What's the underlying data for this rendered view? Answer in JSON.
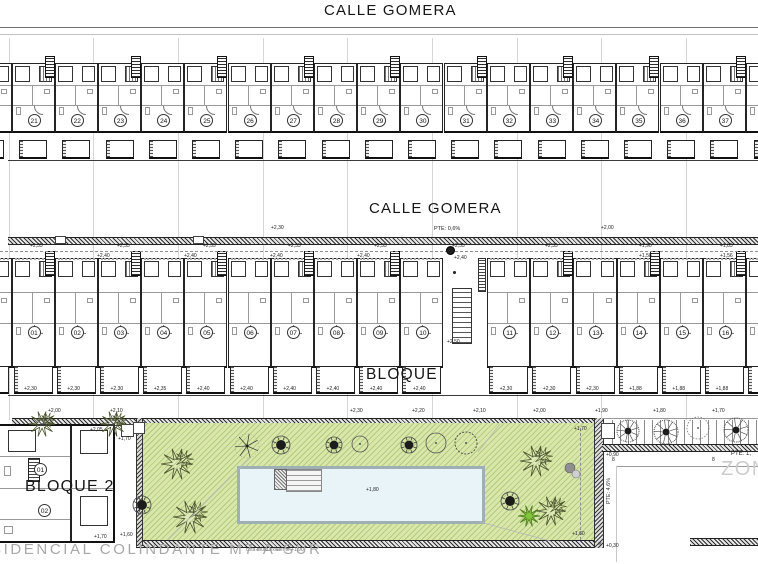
{
  "drawing": {
    "street_top": "CALLE GOMERA",
    "street_mid": "CALLE GOMERA",
    "street_slope": "PTE: 0,6%",
    "bloque1_label": "BLOQUE 1",
    "bloque2_label": "BLOQUE 2",
    "adjacent_text": "SIDENCIAL COLINDANTE M7-A-SUR",
    "wall_note": "cota muro existente +1,90",
    "zona_label": "ZONA",
    "pte_right": "PTE: 1,",
    "ramp_slope": "PTE: 4,6%",
    "ramp_level_top": "+0,90",
    "ramp_level_bottom": "+0,30",
    "cross_mark": "×"
  },
  "row1": {
    "units": [
      "21",
      "22",
      "23",
      "24",
      "25",
      "26",
      "27",
      "28",
      "29",
      "30",
      "31",
      "32",
      "33",
      "34",
      "35",
      "36",
      "37"
    ]
  },
  "row2": {
    "left_units": [
      {
        "num": "01",
        "patio_level": "+2,30"
      },
      {
        "num": "02",
        "patio_level": "+2,30"
      },
      {
        "num": "03",
        "patio_level": "+2,30"
      },
      {
        "num": "04",
        "patio_level": "+2,35"
      },
      {
        "num": "05",
        "patio_level": "+2,40"
      },
      {
        "num": "06",
        "patio_level": "+2,40"
      },
      {
        "num": "07",
        "patio_level": "+2,40"
      },
      {
        "num": "08",
        "patio_level": "+2,40"
      },
      {
        "num": "09",
        "patio_level": "+2,40"
      },
      {
        "num": "10",
        "patio_level": "+2,40"
      }
    ],
    "right_units": [
      {
        "num": "11",
        "patio_level": "+2,30"
      },
      {
        "num": "12",
        "patio_level": "+2,30"
      },
      {
        "num": "13",
        "patio_level": "+2,30"
      },
      {
        "num": "14",
        "patio_level": "+1,88"
      },
      {
        "num": "15",
        "patio_level": "+1,88"
      },
      {
        "num": "16",
        "patio_level": "+1,88"
      },
      {
        "num": "17",
        "patio_level": "+1,88"
      }
    ],
    "passage_levels": {
      "upper": "+2,40",
      "lower": "+2,50"
    }
  },
  "street_levels": {
    "above": [
      {
        "x": 271,
        "v": "+2,30"
      },
      {
        "x": 601,
        "v": "+2,00"
      }
    ],
    "below": [
      {
        "x": 30,
        "v": "+2,35"
      },
      {
        "x": 117,
        "v": "+2,35"
      },
      {
        "x": 203,
        "v": "+2,35"
      },
      {
        "x": 288,
        "v": "+2,35"
      },
      {
        "x": 374,
        "v": "+2,35"
      },
      {
        "x": 452,
        "v": "+2,35"
      },
      {
        "x": 545,
        "v": "+2,35"
      },
      {
        "x": 639,
        "v": "+1,90"
      },
      {
        "x": 720,
        "v": "+1,85"
      }
    ],
    "building_line": [
      {
        "x": 97,
        "v": "+2,40"
      },
      {
        "x": 184,
        "v": "+2,40"
      },
      {
        "x": 270,
        "v": "+2,40"
      },
      {
        "x": 357,
        "v": "+2,40"
      },
      {
        "x": 639,
        "v": "+1,58"
      },
      {
        "x": 720,
        "v": "+1,56"
      }
    ]
  },
  "walkway_levels": [
    {
      "x": 48,
      "v": "+2,00"
    },
    {
      "x": 110,
      "v": "+2,10"
    },
    {
      "x": 350,
      "v": "+2,30"
    },
    {
      "x": 412,
      "v": "+2,20"
    },
    {
      "x": 473,
      "v": "+2,10"
    },
    {
      "x": 533,
      "v": "+2,00"
    },
    {
      "x": 595,
      "v": "+1,90"
    },
    {
      "x": 653,
      "v": "+1,80"
    },
    {
      "x": 712,
      "v": "+1,70"
    }
  ],
  "bloque2": {
    "unit_numbers": [
      "01",
      "02"
    ],
    "levels": [
      {
        "x": 90,
        "y": 427,
        "v": "+2,05"
      },
      {
        "x": 94,
        "y": 534,
        "v": "+1,70"
      }
    ]
  },
  "garden": {
    "pool_level": "+1,80",
    "levels": [
      {
        "x": 118,
        "y": 436,
        "v": "+1,70"
      },
      {
        "x": 120,
        "y": 532,
        "v": "+1,60"
      },
      {
        "x": 574,
        "y": 426,
        "v": "+1,70"
      },
      {
        "x": 572,
        "y": 531,
        "v": "+1,60"
      }
    ],
    "trees": [
      {
        "t": "flower",
        "x": 177,
        "y": 464,
        "r": 16
      },
      {
        "t": "flower",
        "x": 190,
        "y": 517,
        "r": 17
      },
      {
        "t": "dark",
        "x": 142,
        "y": 505,
        "r": 9
      },
      {
        "t": "branched",
        "x": 247,
        "y": 446,
        "r": 12
      },
      {
        "t": "dark",
        "x": 281,
        "y": 445,
        "r": 9
      },
      {
        "t": "dark",
        "x": 334,
        "y": 445,
        "r": 8
      },
      {
        "t": "outline",
        "x": 360,
        "y": 444,
        "r": 8
      },
      {
        "t": "dark",
        "x": 409,
        "y": 445,
        "r": 8
      },
      {
        "t": "outline",
        "x": 436,
        "y": 443,
        "r": 10
      },
      {
        "t": "scalloped",
        "x": 466,
        "y": 443,
        "r": 11
      },
      {
        "t": "flower",
        "x": 536,
        "y": 461,
        "r": 16
      },
      {
        "t": "flower",
        "x": 551,
        "y": 511,
        "r": 15
      },
      {
        "t": "green",
        "x": 529,
        "y": 516,
        "r": 11
      },
      {
        "t": "dark",
        "x": 510,
        "y": 501,
        "r": 9
      },
      {
        "t": "pair",
        "x": 570,
        "y": 468,
        "r": 5
      },
      {
        "t": "flower",
        "x": 42,
        "y": 424,
        "r": 13
      },
      {
        "t": "flower",
        "x": 113,
        "y": 424,
        "r": 13
      },
      {
        "t": "scribble",
        "x": 628,
        "y": 431,
        "r": 11
      },
      {
        "t": "scribble",
        "x": 666,
        "y": 432,
        "r": 12
      },
      {
        "t": "dashedc",
        "x": 698,
        "y": 428,
        "r": 11
      },
      {
        "t": "scribble",
        "x": 736,
        "y": 430,
        "r": 12
      }
    ]
  },
  "right_zone": {
    "section_marks": [
      {
        "x": 612,
        "y": 457,
        "v": "8"
      },
      {
        "x": 712,
        "y": 457,
        "v": "8"
      }
    ]
  }
}
